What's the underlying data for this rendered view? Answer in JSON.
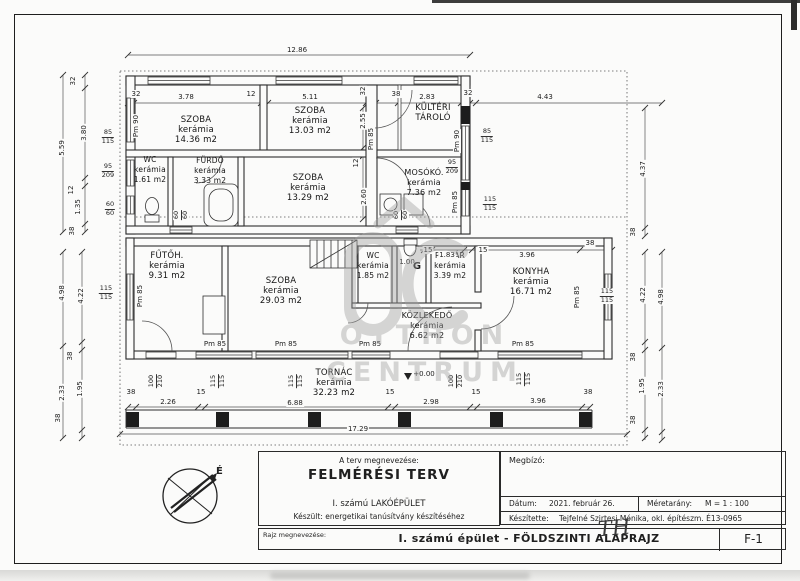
{
  "title_block": {
    "plan_name_caption": "A terv megnevezése:",
    "plan_name": "FELMÉRÉSI TERV",
    "building": "I. számú LAKÓÉPÜLET",
    "purpose": "Készült: energetikai tanúsítvány készítéséhez",
    "client_caption": "Megbízó:",
    "date_caption": "Dátum:",
    "date": "2021. február 26.",
    "scale_caption": "Méretarány:",
    "scale": "M = 1 : 100",
    "author_caption": "Készítette:",
    "author": "Tejfelné Szirtesi Mónika, okl. építészm. É13-0965",
    "drawing_caption": "Rajz megnevezése:",
    "drawing_title": "I. számú épület - FÖLDSZINTI ALAPRAJZ",
    "sheet_number": "F-1",
    "signature": "TH"
  },
  "compass": {
    "north_label": "É"
  },
  "watermark": {
    "line1": "OTTHON",
    "line2": "CENTRUM",
    "color": "#9f9f9f"
  },
  "rooms": [
    {
      "lines": [
        "SZOBA",
        "kerámia",
        "14.36 m2"
      ],
      "x": 196,
      "y": 115
    },
    {
      "lines": [
        "SZOBA",
        "kerámia",
        "13.03 m2"
      ],
      "x": 310,
      "y": 106
    },
    {
      "lines": [
        "KÜLTÉRI",
        "TÁROLÓ"
      ],
      "x": 433,
      "y": 103
    },
    {
      "lines": [
        "WC",
        "kerámia",
        "1.61 m2"
      ],
      "x": 150,
      "y": 155,
      "fs": 7.5
    },
    {
      "lines": [
        "FÜRDŐ",
        "kerámia",
        "3.33 m2"
      ],
      "x": 210,
      "y": 156,
      "fs": 7.5
    },
    {
      "lines": [
        "SZOBA",
        "kerámia",
        "13.29 m2"
      ],
      "x": 308,
      "y": 173
    },
    {
      "lines": [
        "MOSÓKÓ.",
        "kerámia",
        "7.36 m2"
      ],
      "x": 424,
      "y": 168,
      "fs": 8
    },
    {
      "lines": [
        "FŰTŐH.",
        "kerámia",
        "9.31 m2"
      ],
      "x": 167,
      "y": 251
    },
    {
      "lines": [
        "SZOBA",
        "kerámia",
        "29.03 m2"
      ],
      "x": 281,
      "y": 276
    },
    {
      "lines": [
        "WC",
        "kerámia",
        "1.85 m2"
      ],
      "x": 373,
      "y": 251,
      "fs": 7.5
    },
    {
      "lines": [
        "RAKTÁR",
        "kerámia",
        "3.39 m2"
      ],
      "x": 450,
      "y": 251,
      "fs": 7.5
    },
    {
      "lines": [
        "KONYHA",
        "kerámia",
        "16.71 m2"
      ],
      "x": 531,
      "y": 267
    },
    {
      "lines": [
        "KÖZLEKEDŐ",
        "kerámia",
        "6.62 m2"
      ],
      "x": 427,
      "y": 311,
      "fs": 8
    },
    {
      "lines": [
        "TORNÁC",
        "kerámia",
        "32.23 m2"
      ],
      "x": 334,
      "y": 368
    }
  ],
  "dims": [
    {
      "t": "12.86",
      "x": 297,
      "y": 50
    },
    {
      "t": "32",
      "x": 136,
      "y": 94
    },
    {
      "t": "3.78",
      "x": 186,
      "y": 97
    },
    {
      "t": "12",
      "x": 251,
      "y": 94
    },
    {
      "t": "5.11",
      "x": 310,
      "y": 97
    },
    {
      "t": "32",
      "x": 363,
      "y": 91,
      "r": 1
    },
    {
      "t": "38",
      "x": 396,
      "y": 94
    },
    {
      "t": "2.83",
      "x": 427,
      "y": 97
    },
    {
      "t": "32",
      "x": 468,
      "y": 93
    },
    {
      "t": "4.43",
      "x": 545,
      "y": 97
    },
    {
      "t": "5.59",
      "x": 62,
      "y": 148,
      "r": 1
    },
    {
      "t": "32",
      "x": 73,
      "y": 81,
      "r": 1
    },
    {
      "t": "3.80",
      "x": 84,
      "y": 133,
      "r": 1
    },
    {
      "t": "12",
      "x": 71,
      "y": 190,
      "r": 1
    },
    {
      "t": "1.35",
      "x": 78,
      "y": 207,
      "r": 1
    },
    {
      "t": "38",
      "x": 72,
      "y": 231,
      "r": 1
    },
    {
      "t": "4.98",
      "x": 62,
      "y": 293,
      "r": 1
    },
    {
      "t": "4.22",
      "x": 81,
      "y": 296,
      "r": 1
    },
    {
      "t": "38",
      "x": 70,
      "y": 356,
      "r": 1
    },
    {
      "t": "2.33",
      "x": 62,
      "y": 393,
      "r": 1
    },
    {
      "t": "1.95",
      "x": 80,
      "y": 389,
      "r": 1
    },
    {
      "t": "38",
      "x": 58,
      "y": 418,
      "r": 1
    },
    {
      "t": "4.37",
      "x": 643,
      "y": 169,
      "r": 1
    },
    {
      "t": "38",
      "x": 633,
      "y": 232,
      "r": 1
    },
    {
      "t": "4.22",
      "x": 643,
      "y": 295,
      "r": 1
    },
    {
      "t": "4.98",
      "x": 661,
      "y": 297,
      "r": 1
    },
    {
      "t": "38",
      "x": 633,
      "y": 357,
      "r": 1
    },
    {
      "t": "1.95",
      "x": 642,
      "y": 386,
      "r": 1
    },
    {
      "t": "2.33",
      "x": 661,
      "y": 389,
      "r": 1
    },
    {
      "t": "38",
      "x": 633,
      "y": 420,
      "r": 1
    },
    {
      "t": "2.55",
      "x": 363,
      "y": 121,
      "r": 1
    },
    {
      "t": "12",
      "x": 356,
      "y": 163,
      "r": 1
    },
    {
      "t": "2.60",
      "x": 364,
      "y": 197,
      "r": 1
    },
    {
      "t": "15",
      "x": 428,
      "y": 250
    },
    {
      "t": "1.83",
      "x": 447,
      "y": 255
    },
    {
      "t": "15",
      "x": 483,
      "y": 250
    },
    {
      "t": "3.96",
      "x": 527,
      "y": 255
    },
    {
      "t": "38",
      "x": 590,
      "y": 243
    },
    {
      "t": "1.00",
      "x": 407,
      "y": 262
    },
    {
      "t": "38",
      "x": 131,
      "y": 392
    },
    {
      "t": "2.26",
      "x": 168,
      "y": 402
    },
    {
      "t": "15",
      "x": 201,
      "y": 392
    },
    {
      "t": "6.88",
      "x": 295,
      "y": 403
    },
    {
      "t": "15",
      "x": 390,
      "y": 392
    },
    {
      "t": "2.98",
      "x": 431,
      "y": 402
    },
    {
      "t": "15",
      "x": 476,
      "y": 392
    },
    {
      "t": "3.96",
      "x": 538,
      "y": 401
    },
    {
      "t": "38",
      "x": 588,
      "y": 392
    },
    {
      "t": "17.29",
      "x": 358,
      "y": 429
    },
    {
      "t": "+0.00",
      "x": 424,
      "y": 374
    },
    {
      "t": "Pm 90",
      "x": 136,
      "y": 126,
      "r": 1
    },
    {
      "t": "Pm 85",
      "x": 371,
      "y": 139,
      "r": 1
    },
    {
      "t": "Pm 90",
      "x": 457,
      "y": 141,
      "r": 1
    },
    {
      "t": "Pm 85",
      "x": 455,
      "y": 202,
      "r": 1
    },
    {
      "t": "Pm 85",
      "x": 140,
      "y": 296,
      "r": 1
    },
    {
      "t": "Pm 85",
      "x": 577,
      "y": 297,
      "r": 1
    },
    {
      "t": "Pm 85",
      "x": 215,
      "y": 344
    },
    {
      "t": "Pm 85",
      "x": 286,
      "y": 344
    },
    {
      "t": "Pm 85",
      "x": 370,
      "y": 344
    },
    {
      "t": "Pm 85",
      "x": 523,
      "y": 344
    },
    {
      "t": "G",
      "x": 417,
      "y": 267,
      "fs": 10,
      "b": 1
    }
  ],
  "fracs": [
    {
      "a": "85",
      "b": "115",
      "x": 108,
      "y": 137
    },
    {
      "a": "95",
      "b": "209",
      "x": 108,
      "y": 171
    },
    {
      "a": "60",
      "b": "60",
      "x": 110,
      "y": 209
    },
    {
      "a": "85",
      "b": "115",
      "x": 487,
      "y": 136
    },
    {
      "a": "95",
      "b": "209",
      "x": 452,
      "y": 167
    },
    {
      "a": "115",
      "b": "115",
      "x": 490,
      "y": 204
    },
    {
      "a": "115",
      "b": "115",
      "x": 106,
      "y": 293
    },
    {
      "a": "115",
      "b": "115",
      "x": 607,
      "y": 296
    },
    {
      "a": "60",
      "b": "60",
      "x": 181,
      "y": 215,
      "r": 1
    },
    {
      "a": "60",
      "b": "60",
      "x": 401,
      "y": 215,
      "r": 1
    },
    {
      "a": "100",
      "b": "210",
      "x": 156,
      "y": 381,
      "r": 1
    },
    {
      "a": "115",
      "b": "115",
      "x": 218,
      "y": 381,
      "r": 1
    },
    {
      "a": "115",
      "b": "115",
      "x": 296,
      "y": 381,
      "r": 1
    },
    {
      "a": "100",
      "b": "210",
      "x": 456,
      "y": 381,
      "r": 1
    },
    {
      "a": "115",
      "b": "115",
      "x": 524,
      "y": 379,
      "r": 1
    }
  ]
}
